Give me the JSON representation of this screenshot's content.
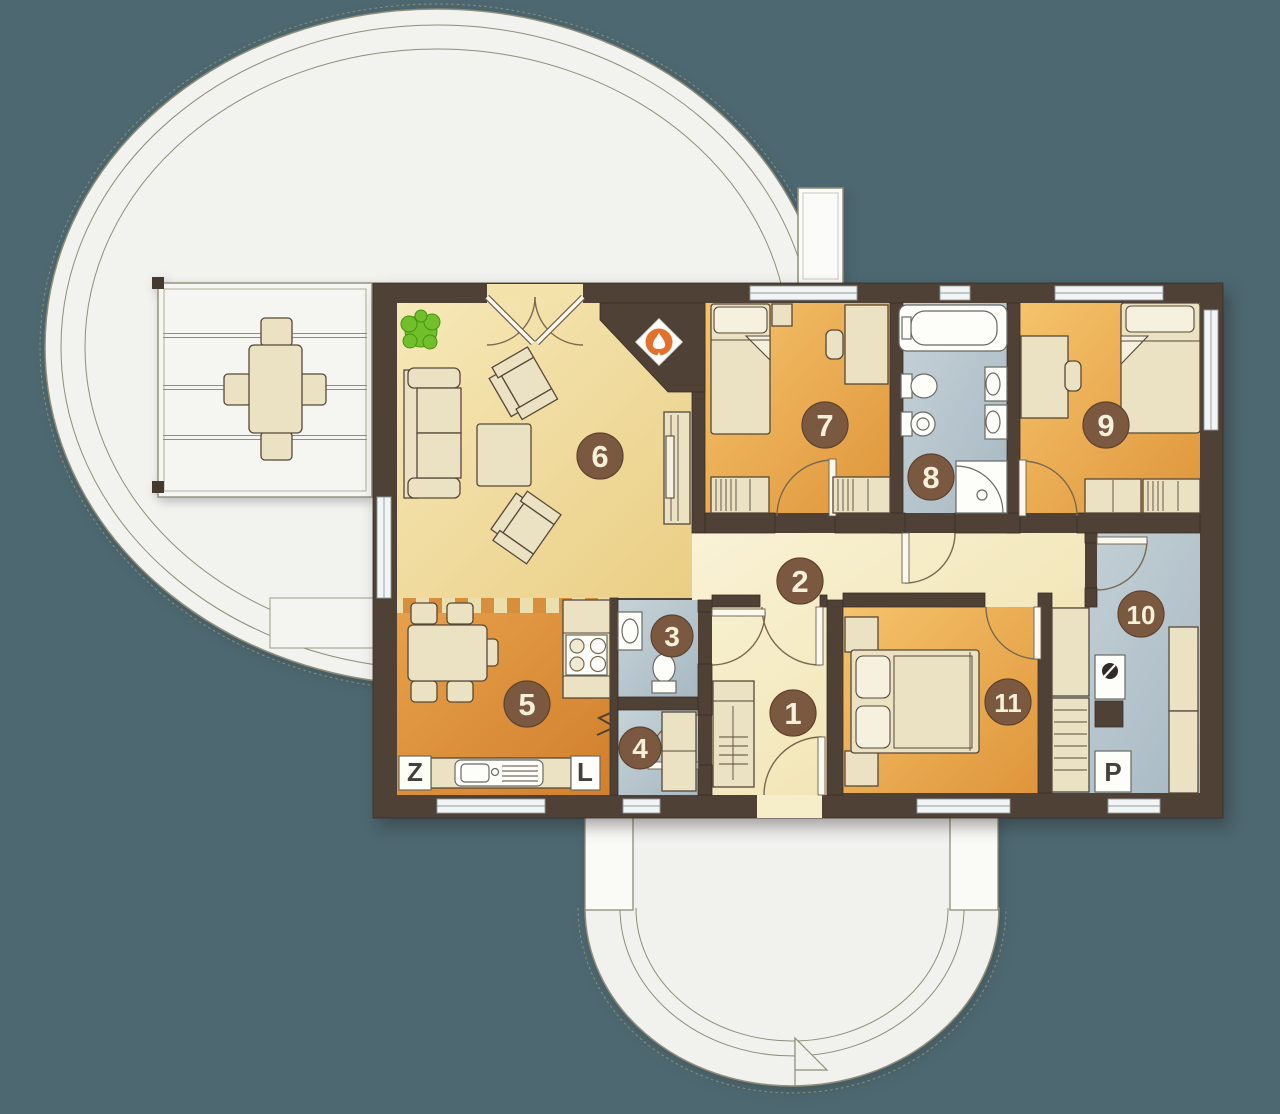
{
  "plan": {
    "description": "single-storey house floor plan with oval terrace and semicircular entry porch",
    "room_labels": [
      {
        "number": "1"
      },
      {
        "number": "2"
      },
      {
        "number": "3"
      },
      {
        "number": "4"
      },
      {
        "number": "5"
      },
      {
        "number": "6"
      },
      {
        "number": "7"
      },
      {
        "number": "8"
      },
      {
        "number": "9"
      },
      {
        "number": "10"
      },
      {
        "number": "11"
      }
    ],
    "appliance_labels": [
      {
        "label": "Z"
      },
      {
        "label": "L"
      },
      {
        "label": "P"
      }
    ],
    "colors": {
      "background": "#4d6871",
      "walls": "#4f4136",
      "living_floor": "#f2e2a9",
      "hall_floor": "#f7efce",
      "bedroom_floor": "#ecad52",
      "kitchen_floor": "#dd9140",
      "wet_room_floor": "#b7c5ce",
      "terrace": "#f2f2ef",
      "furniture": "#ebe2c4",
      "label_circle": "#7b5940",
      "plant_green": "#72bf2c",
      "flame_orange": "#e4702c"
    }
  }
}
